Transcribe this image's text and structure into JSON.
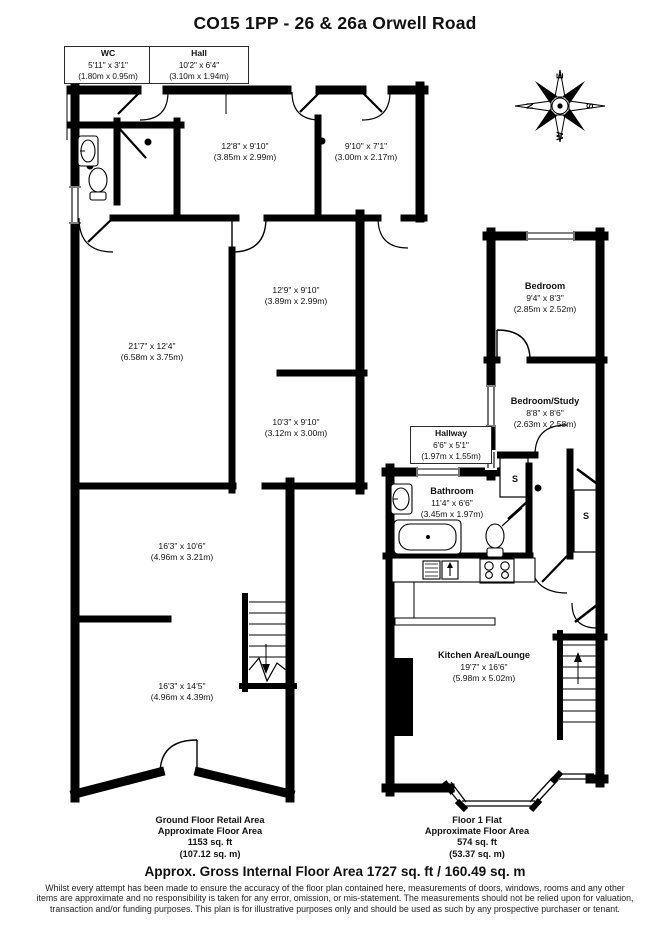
{
  "title": "CO15 1PP - 26 & 26a Orwell Road",
  "compass": {
    "n": "N",
    "e": "E",
    "s": "S",
    "w": "W"
  },
  "boxes": {
    "wc": {
      "name": "WC",
      "imperial": "5'11\" x 3'1\"",
      "metric": "(1.80m x 0.95m)"
    },
    "hall": {
      "name": "Hall",
      "imperial": "10'2\" x 6'4\"",
      "metric": "(3.10m x 1.94m)"
    },
    "hallway": {
      "name": "Hallway",
      "imperial": "6'6\" x 5'1\"",
      "metric": "(1.97m x 1.55m)"
    }
  },
  "rooms": {
    "room_12_8": {
      "imperial": "12'8\" x 9'10\"",
      "metric": "(3.85m x 2.99m)"
    },
    "room_9_10": {
      "imperial": "9'10\" x 7'1\"",
      "metric": "(3.00m x 2.17m)"
    },
    "room_12_9": {
      "imperial": "12'9\" x 9'10\"",
      "metric": "(3.89m x 2.99m)"
    },
    "room_21_7": {
      "imperial": "21'7\" x 12'4\"",
      "metric": "(6.58m x 3.75m)"
    },
    "room_10_3": {
      "imperial": "10'3\" x 9'10\"",
      "metric": "(3.12m x 3.00m)"
    },
    "room_16_3a": {
      "imperial": "16'3\" x 10'6\"",
      "metric": "(4.96m x 3.21m)"
    },
    "room_16_3b": {
      "imperial": "16'3\" x 14'5\"",
      "metric": "(4.96m x 4.39m)"
    },
    "bedroom": {
      "name": "Bedroom",
      "imperial": "9'4\" x 8'3\"",
      "metric": "(2.85m x 2.52m)"
    },
    "bedroom_study": {
      "name": "Bedroom/Study",
      "imperial": "8'8\" x 8'6\"",
      "metric": "(2.63m x 2.58m)"
    },
    "bathroom": {
      "name": "Bathroom",
      "imperial": "11'4\" x 6'6\"",
      "metric": "(3.45m x 1.97m)"
    },
    "kitchen_lounge": {
      "name": "Kitchen Area/Lounge",
      "imperial": "19'7\" x 16'6\"",
      "metric": "(5.98m x 5.02m)"
    }
  },
  "storage_label": "S",
  "captions": {
    "ground_floor": {
      "line1": "Ground Floor Retail Area",
      "line2": "Approximate Floor Area",
      "line3": "1153 sq. ft",
      "line4": "(107.12 sq. m)"
    },
    "flat": {
      "line1": "Floor 1 Flat",
      "line2": "Approximate Floor Area",
      "line3": "574 sq. ft",
      "line4": "(53.37 sq. m)"
    }
  },
  "footer": {
    "total": "Approx. Gross Internal Floor Area 1727 sq. ft / 160.49 sq. m",
    "disclaimer": "Whilst every attempt has been made to ensure the accuracy of the floor plan contained here, measurements of doors, windows, rooms and any other items are approximate and no responsibility is taken for any error, omission, or mis-statement. The measurements should not be relied upon for valuation, transaction and/or funding purposes. This plan is for illustrative purposes only and should be used as such by any prospective purchaser or tenant."
  }
}
